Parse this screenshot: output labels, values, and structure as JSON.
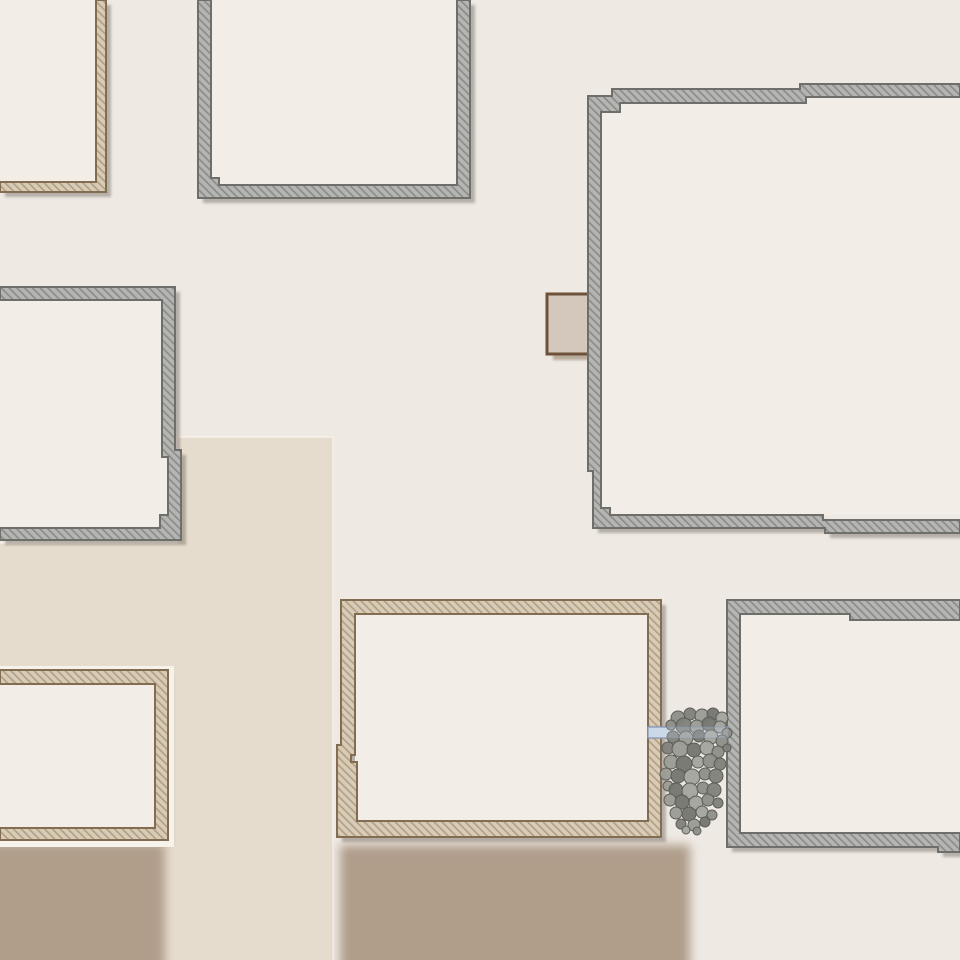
{
  "scene": {
    "width": 960,
    "height": 960,
    "kind": "top-down-map-tile"
  },
  "palette": {
    "background": "#eee9e3",
    "floor": "#f2ede7",
    "path": "#e6dccd",
    "path_edge_highlight": "rgba(250,246,238,0.75)",
    "dirt": "#b09e8b",
    "building_shadow": "rgba(100,94,87,0.42)",
    "halo": "#f6f2ec",
    "wall_styles": {
      "gray": {
        "fill": "#b5b5b3",
        "hatch": "#8c8c89",
        "border": "#6e6e6b"
      },
      "tan": {
        "fill": "#d8ccb8",
        "hatch": "#b2a084",
        "border": "#836d52"
      }
    },
    "hatch": {
      "spacing": 5.5,
      "line_width": 1.7,
      "angle": -45
    },
    "table": {
      "fill": "#d3c8bb",
      "border": "#6d5139",
      "shadow": "rgba(139,119,98,0.55)"
    },
    "plank": {
      "fill": "#cbd8e7",
      "border": "#8598b3"
    },
    "rock_fills": [
      "#8f8f8a",
      "#81817c",
      "#9b9b96",
      "#767671",
      "#a4a49f"
    ],
    "rock_stroke": "#5d5d58"
  },
  "grounds": {
    "path_rects": [
      {
        "x": 177,
        "y": 437,
        "w": 156,
        "h": 523
      },
      {
        "x": 0,
        "y": 543,
        "w": 178,
        "h": 417
      }
    ],
    "path_edge": [
      [
        0,
        543
      ],
      [
        177,
        543
      ],
      [
        177,
        437
      ],
      [
        333,
        437
      ],
      [
        333,
        960
      ]
    ],
    "dirt_rects": [
      {
        "x": -30,
        "y": 843,
        "w": 195,
        "h": 160
      },
      {
        "x": 340,
        "y": 845,
        "w": 350,
        "h": 160
      }
    ]
  },
  "buildings": [
    {
      "id": "building-top-left",
      "style": "tan",
      "floors": [
        [
          0,
          0,
          96,
          182
        ]
      ],
      "poly": [
        [
          [
            96,
            0
          ],
          [
            106,
            0
          ],
          [
            106,
            192
          ],
          [
            0,
            192
          ],
          [
            0,
            182
          ],
          [
            96,
            182
          ]
        ]
      ]
    },
    {
      "id": "building-top-center",
      "style": "gray",
      "floors": [
        [
          211,
          0,
          246,
          185
        ]
      ],
      "poly": [
        [
          [
            198,
            0
          ],
          [
            211,
            0
          ],
          [
            211,
            178
          ],
          [
            219,
            178
          ],
          [
            219,
            185
          ],
          [
            457,
            185
          ],
          [
            457,
            0
          ],
          [
            470,
            0
          ],
          [
            470,
            198
          ],
          [
            198,
            198
          ]
        ]
      ]
    },
    {
      "id": "building-mid-left",
      "style": "gray",
      "floors": [
        [
          0,
          300,
          162,
          228
        ],
        [
          160,
          457,
          8,
          58
        ]
      ],
      "poly": [
        [
          [
            0,
            287
          ],
          [
            175,
            287
          ],
          [
            175,
            450
          ],
          [
            181,
            450
          ],
          [
            181,
            540
          ],
          [
            0,
            540
          ],
          [
            0,
            528
          ],
          [
            160,
            528
          ],
          [
            160,
            515
          ],
          [
            168,
            515
          ],
          [
            168,
            457
          ],
          [
            162,
            457
          ],
          [
            162,
            300
          ],
          [
            0,
            300
          ]
        ]
      ]
    },
    {
      "id": "building-top-right",
      "style": "gray",
      "floors": [
        [
          601,
          97,
          359,
          418
        ]
      ],
      "poly": [
        [
          [
            588,
            96
          ],
          [
            612,
            96
          ],
          [
            612,
            89
          ],
          [
            800,
            89
          ],
          [
            800,
            84
          ],
          [
            960,
            84
          ],
          [
            960,
            97
          ],
          [
            806,
            97
          ],
          [
            806,
            103
          ],
          [
            620,
            103
          ],
          [
            620,
            112
          ],
          [
            601,
            112
          ],
          [
            601,
            508
          ],
          [
            610,
            508
          ],
          [
            610,
            515
          ],
          [
            823,
            515
          ],
          [
            823,
            520
          ],
          [
            960,
            520
          ],
          [
            960,
            533
          ],
          [
            825,
            533
          ],
          [
            825,
            528
          ],
          [
            593,
            528
          ],
          [
            593,
            471
          ],
          [
            588,
            471
          ]
        ]
      ]
    },
    {
      "id": "building-bottom-left",
      "style": "tan",
      "halo": {
        "x": -6,
        "y": 666,
        "w": 180,
        "h": 181
      },
      "floors": [
        [
          0,
          684,
          155,
          144
        ]
      ],
      "poly": [
        [
          [
            0,
            670
          ],
          [
            168,
            670
          ],
          [
            168,
            840
          ],
          [
            0,
            840
          ],
          [
            0,
            828
          ],
          [
            155,
            828
          ],
          [
            155,
            684
          ],
          [
            0,
            684
          ]
        ]
      ]
    },
    {
      "id": "building-bottom-center",
      "style": "tan",
      "floors": [
        [
          355,
          614,
          293,
          207
        ]
      ],
      "poly": [
        [
          [
            341,
            600
          ],
          [
            661,
            600
          ],
          [
            661,
            837
          ],
          [
            337,
            837
          ],
          [
            337,
            745
          ],
          [
            341,
            745
          ]
        ],
        [
          [
            355,
            614
          ],
          [
            648,
            614
          ],
          [
            648,
            821
          ],
          [
            357,
            821
          ],
          [
            357,
            762
          ],
          [
            351,
            762
          ],
          [
            351,
            755
          ],
          [
            355,
            755
          ]
        ]
      ]
    },
    {
      "id": "building-bottom-right",
      "style": "gray",
      "floors": [
        [
          740,
          614,
          220,
          219
        ]
      ],
      "poly": [
        [
          [
            727,
            600
          ],
          [
            960,
            600
          ],
          [
            960,
            620
          ],
          [
            850,
            620
          ],
          [
            850,
            614
          ],
          [
            740,
            614
          ],
          [
            740,
            833
          ],
          [
            960,
            833
          ],
          [
            960,
            852
          ],
          [
            938,
            852
          ],
          [
            938,
            847
          ],
          [
            727,
            847
          ]
        ]
      ]
    }
  ],
  "props": {
    "table": {
      "x": 547,
      "y": 294,
      "w": 58,
      "h": 60
    },
    "plank": {
      "x": 648,
      "y": 727,
      "w": 80,
      "h": 11
    },
    "rocks": [
      [
        678,
        718,
        7
      ],
      [
        690,
        714,
        6
      ],
      [
        702,
        716,
        7
      ],
      [
        713,
        714,
        6
      ],
      [
        722,
        718,
        6
      ],
      [
        671,
        725,
        5
      ],
      [
        684,
        726,
        8
      ],
      [
        697,
        727,
        7
      ],
      [
        709,
        724,
        7
      ],
      [
        720,
        727,
        6
      ],
      [
        727,
        733,
        5
      ],
      [
        673,
        737,
        6
      ],
      [
        686,
        738,
        7
      ],
      [
        699,
        736,
        6
      ],
      [
        711,
        737,
        7
      ],
      [
        722,
        741,
        6
      ],
      [
        668,
        748,
        6
      ],
      [
        680,
        749,
        8
      ],
      [
        694,
        750,
        7
      ],
      [
        707,
        748,
        7
      ],
      [
        718,
        752,
        6
      ],
      [
        727,
        748,
        4
      ],
      [
        671,
        762,
        7
      ],
      [
        684,
        764,
        8
      ],
      [
        698,
        762,
        6
      ],
      [
        710,
        761,
        7
      ],
      [
        720,
        764,
        6
      ],
      [
        666,
        774,
        6
      ],
      [
        678,
        776,
        7
      ],
      [
        692,
        777,
        8
      ],
      [
        705,
        774,
        6
      ],
      [
        716,
        776,
        7
      ],
      [
        668,
        786,
        5
      ],
      [
        676,
        790,
        7
      ],
      [
        690,
        791,
        8
      ],
      [
        703,
        788,
        6
      ],
      [
        714,
        790,
        7
      ],
      [
        670,
        800,
        6
      ],
      [
        682,
        802,
        7
      ],
      [
        696,
        803,
        7
      ],
      [
        708,
        800,
        6
      ],
      [
        718,
        803,
        5
      ],
      [
        676,
        813,
        6
      ],
      [
        689,
        814,
        7
      ],
      [
        702,
        812,
        6
      ],
      [
        712,
        815,
        5
      ],
      [
        681,
        824,
        5
      ],
      [
        694,
        825,
        6
      ],
      [
        705,
        822,
        5
      ],
      [
        686,
        830,
        4
      ],
      [
        697,
        831,
        4
      ]
    ]
  }
}
